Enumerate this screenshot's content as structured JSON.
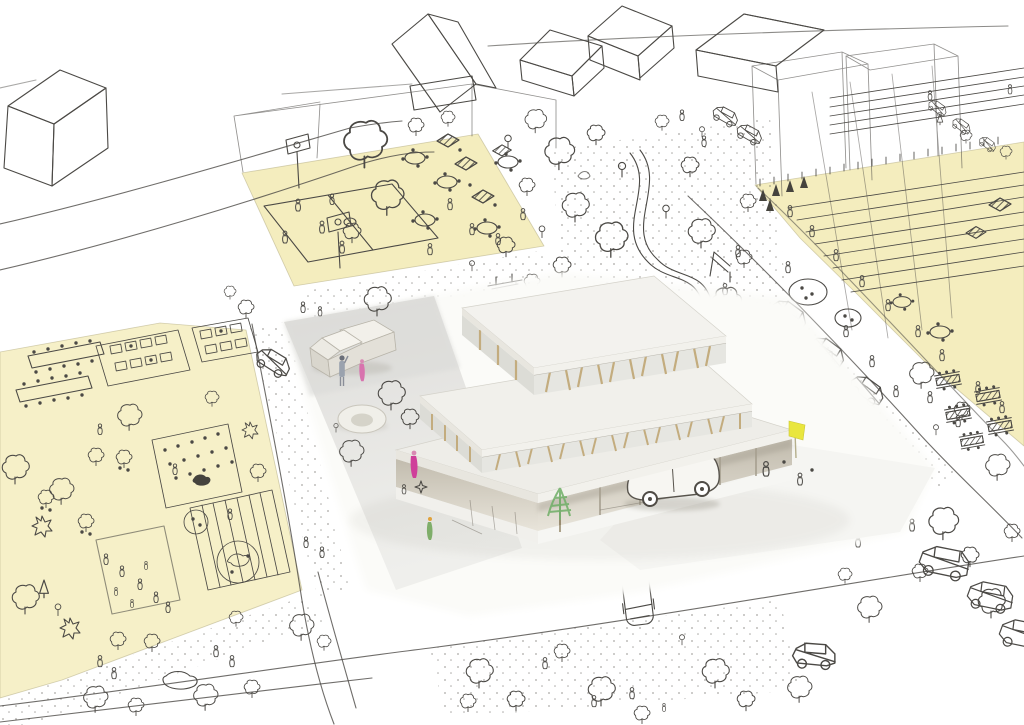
{
  "scene": {
    "kind": "architectural-sketch-collage",
    "media": "hand-drawn ink neighborhood sketch around a photographed stepped cardboard model",
    "colors": {
      "background": "#ffffff",
      "ink": "#4b4945",
      "zone_yellow": "#f4edbe",
      "zone_yellow_light": "#f6f0c8",
      "zone_outline": "#b9b28a",
      "plaza_top": "#deddda",
      "plaza_bottom": "#efefec",
      "ground_white": "#fbfbf8",
      "roof_white": "#f3f2ee",
      "roof_mid": "#f1f0eb",
      "roof_low": "#eeede8",
      "slab_edge": "#e8e6df",
      "slab_edge_bright": "#f2f1ec",
      "band_glass": "#e6e6e1",
      "band_glass_dark": "#dcdcd6",
      "fin_tan": "#c3ac7e",
      "recess_top": "#c2bcae",
      "recess_bottom": "#e8e4da",
      "shadow": "#8a8678",
      "accent_pink": "#cf3f9a",
      "accent_pink_light": "#d873ae",
      "accent_blue_gray": "#9aa2ae",
      "accent_green": "#7fae6a",
      "model_tree_green": "#6fae66",
      "flag_yellow": "#e9e63e",
      "accent_orange": "#e0a23c"
    },
    "zones": [
      {
        "id": "community-garden",
        "position": "left",
        "contents": [
          "allotment beds",
          "long tables with diners",
          "orchard trees",
          "striped lawn",
          "animal pens",
          "families"
        ]
      },
      {
        "id": "court-terrace",
        "position": "upper-center",
        "contents": [
          "basketball court",
          "hoops",
          "round cafe tables",
          "dark parasols",
          "trees",
          "players"
        ]
      },
      {
        "id": "playground-field",
        "position": "right",
        "contents": [
          "running lanes",
          "swing set",
          "sand circles",
          "picnic benches",
          "crowds"
        ]
      }
    ],
    "building": {
      "id": "stepped-pavilion-model",
      "tiers": 3,
      "features": [
        "stacked white slab roofs",
        "open glazed floors with timber fins",
        "drive-through ground floor"
      ]
    },
    "model_props": [
      "white truck",
      "white hatchback under canopy",
      "ring fountain",
      "pink figures",
      "blue-gray figure",
      "green crayon tree",
      "yellow flag"
    ],
    "sketch_props": [
      "flat-roof house",
      "gabled houses",
      "transparent volume boxes",
      "winding park path",
      "slide",
      "cars and vans",
      "suv pair",
      "street trees",
      "pedestrians"
    ]
  }
}
